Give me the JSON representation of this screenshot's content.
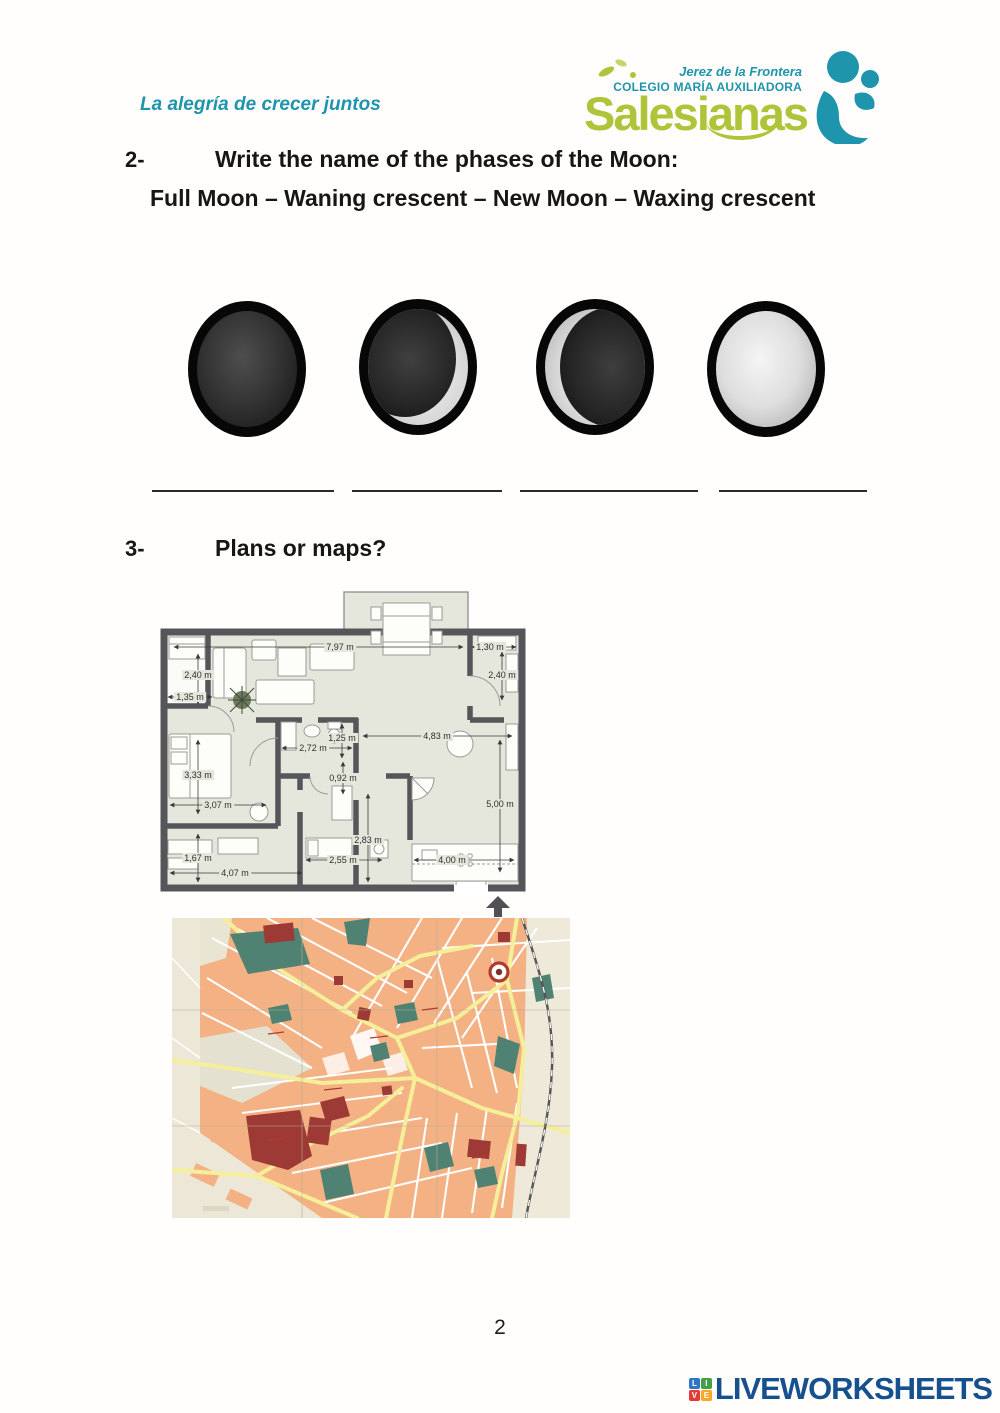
{
  "header": {
    "tagline": "La alegría de crecer juntos",
    "logo": {
      "region": "Jerez de la Frontera",
      "school": "COLEGIO MARÍA AUXILIADORA",
      "brand": "Salesianas",
      "brand_color": "#afc438",
      "teal_color": "#1e95ad"
    }
  },
  "question2": {
    "number": "2-",
    "prompt": "Write the name of the phases of the Moon:",
    "word_bank": "Full Moon – Waning crescent – New Moon – Waxing crescent",
    "moon_icons": [
      "new-moon",
      "crescent-lit-right",
      "crescent-lit-left",
      "full-moon"
    ],
    "blank_count": 4
  },
  "question3": {
    "number": "3-",
    "prompt": "Plans or maps?"
  },
  "floor_plan": {
    "dimensions": [
      "7,97 m",
      "1,30 m",
      "2,40 m",
      "2,40 m",
      "1,35 m",
      "2,72 m",
      "1,25 m",
      "4,83 m",
      "3,33 m",
      "0,92 m",
      "3,07 m",
      "5,00 m",
      "2,83 m",
      "1,67 m",
      "2,55 m",
      "4,07 m",
      "4,00 m"
    ],
    "wall_color": "#55565a",
    "floor_color": "#e6e7dc"
  },
  "city_map": {
    "colors": {
      "background": "#ece7d6",
      "blocks": "#f4b183",
      "streets": "#ffffff",
      "main_roads": "#f6ef9a",
      "parks": "#4f8273",
      "landmarks": "#9e3a36",
      "railway": "#555555"
    }
  },
  "footer": {
    "page_number": "2",
    "brand": "LIVEWORKSHEETS",
    "brand_color": "#17508f",
    "tiles": [
      {
        "letter": "L",
        "color": "#2e75c8"
      },
      {
        "letter": "I",
        "color": "#43a047"
      },
      {
        "letter": "V",
        "color": "#e53935"
      },
      {
        "letter": "E",
        "color": "#f9a825"
      }
    ]
  }
}
